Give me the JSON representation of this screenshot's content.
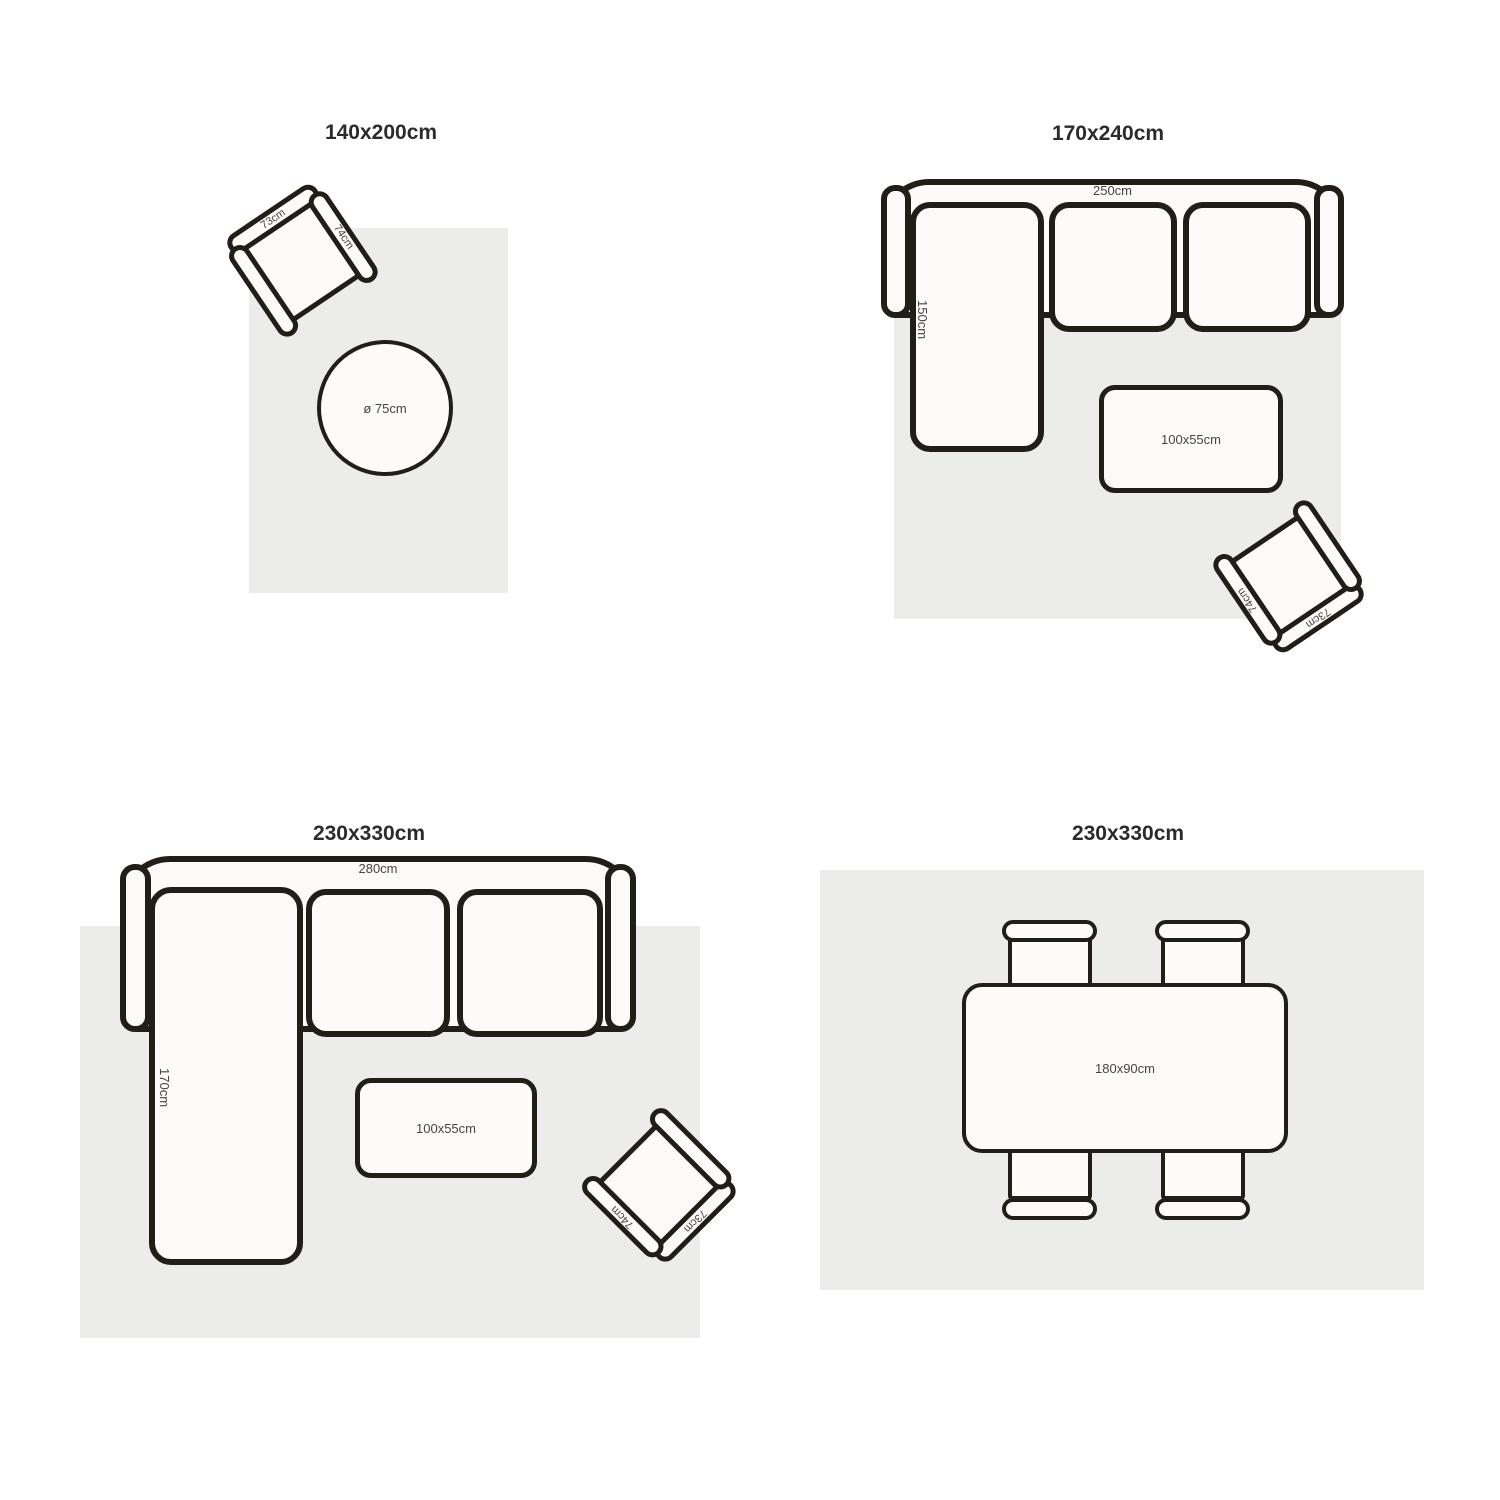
{
  "colors": {
    "ink": "#211e18",
    "rug": "#ececea"
  },
  "panels": [
    {
      "title": "140x200cm",
      "round_table_label": "ø 75cm",
      "chair": {
        "back": "73cm",
        "arm": "74cm"
      }
    },
    {
      "title": "170x240cm",
      "sofa_width": "250cm",
      "chaise_depth": "150cm",
      "coffee_table": "100x55cm",
      "chair": {
        "back": "73cm",
        "arm": "74cm"
      }
    },
    {
      "title": "230x330cm",
      "sofa_width": "280cm",
      "chaise_depth": "170cm",
      "coffee_table": "100x55cm",
      "chair": {
        "back": "73cm",
        "arm": "74cm"
      }
    },
    {
      "title": "230x330cm",
      "dining_table": "180x90cm"
    }
  ]
}
